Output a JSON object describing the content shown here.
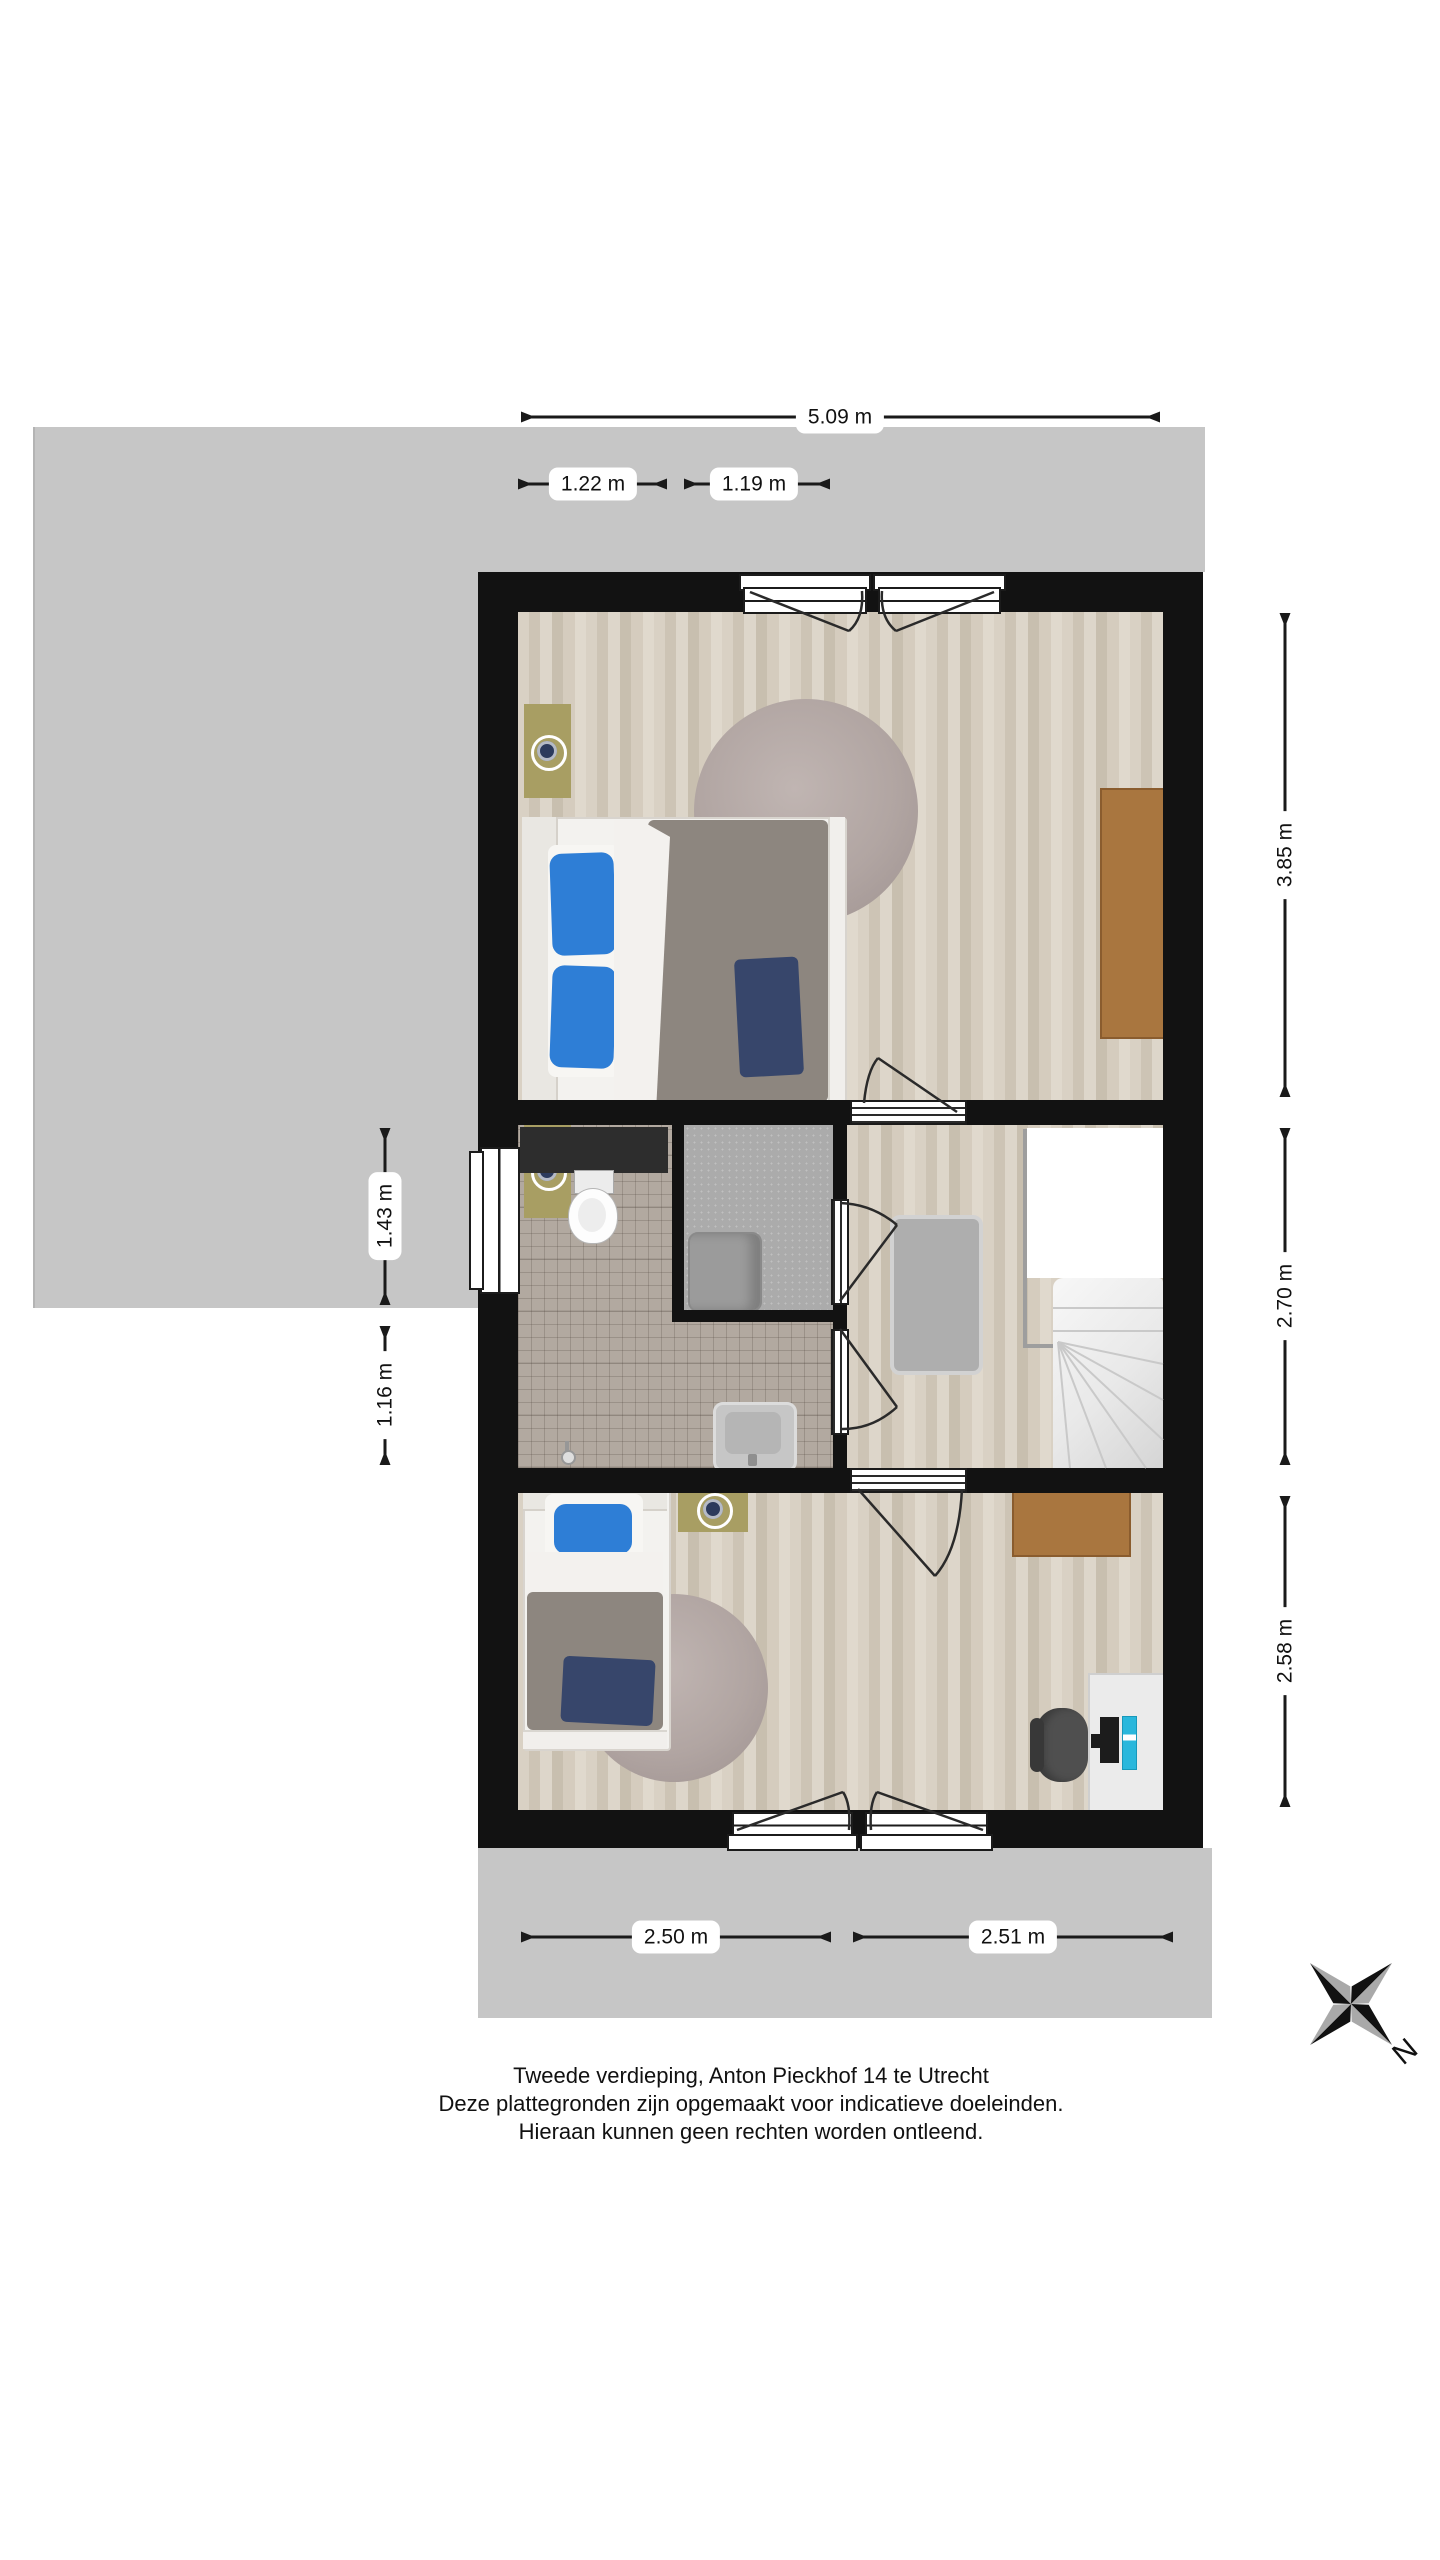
{
  "floorplan": {
    "dimensions": {
      "width_total": "5.09 m",
      "top_segment_left": "1.22 m",
      "top_segment_right": "1.19 m",
      "right_bedroom1": "3.85 m",
      "right_landing": "2.70 m",
      "right_bedroom2": "2.58 m",
      "left_upper": "1.43 m",
      "left_lower": "1.16 m",
      "bottom_left": "2.50 m",
      "bottom_right": "2.51 m"
    },
    "compass": {
      "north": "N"
    },
    "caption": {
      "line1": "Tweede verdieping, Anton Pieckhof 14 te Utrecht",
      "line2": "Deze plattegronden zijn opgemaakt voor indicatieve doeleinden.",
      "line3": "Hieraan kunnen geen rechten worden ontleend."
    },
    "colors": {
      "background": "#ffffff",
      "roof": "#c6c6c6",
      "wall": "#121212",
      "wood": "#d7cfc2",
      "tile": "#b2a9a0",
      "rug": "#b1a5a2",
      "duvet": "#8d867f",
      "pillow": "#2e7ed6",
      "throw": "#37466b",
      "nightstand": "#a89e63",
      "brown": "#a9763f",
      "desk_white": "#ebebeb",
      "chair": "#4f4f4f",
      "pc_cyan": "#2ab7dc",
      "closet_floor": "#ababab",
      "fixture": "#9b9b9b",
      "counter": "#2d2d2d"
    }
  }
}
